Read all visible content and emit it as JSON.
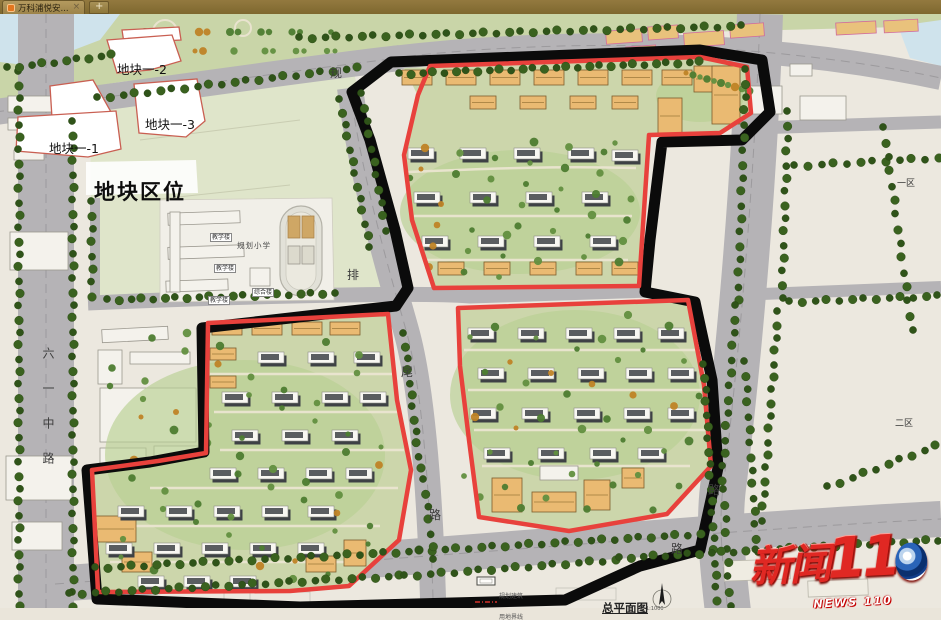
{
  "tab_bar": {
    "active_tab": {
      "title": "万科浦悦安...",
      "close_label": "×"
    },
    "new_tab_label": "+"
  },
  "plan": {
    "plot_labels": {
      "p1": "地块一-1",
      "p2": "地块一-2",
      "p3": "地块一-3"
    },
    "area_title": "地块区位",
    "zone_labels": {
      "zone1": "一区",
      "zone2": "二区"
    },
    "road_labels": {
      "left": "六一中路",
      "top": "规",
      "mid_upper": "排",
      "mid_mid": "尾",
      "mid_lower": "路",
      "right": "路",
      "bottom": "路"
    },
    "school": {
      "name": "规划小学",
      "teaching_building": "教学楼",
      "complex_building": "综合楼"
    },
    "legend": {
      "planned_building": "规划建筑",
      "site_boundary": "用地界线",
      "title": "总平面图",
      "scale": "1:1000"
    },
    "watermark": {
      "cn": "新闻",
      "number": "110",
      "en": "NEWS 110"
    },
    "colors": {
      "boundary_black": "#0b0b0b",
      "boundary_red": "#e8413c",
      "road_gray": "#b5b3b6",
      "parcel_green": "#ccd6ab",
      "water_blue": "#cfe3ec",
      "building_orange": "#eaba72"
    }
  }
}
